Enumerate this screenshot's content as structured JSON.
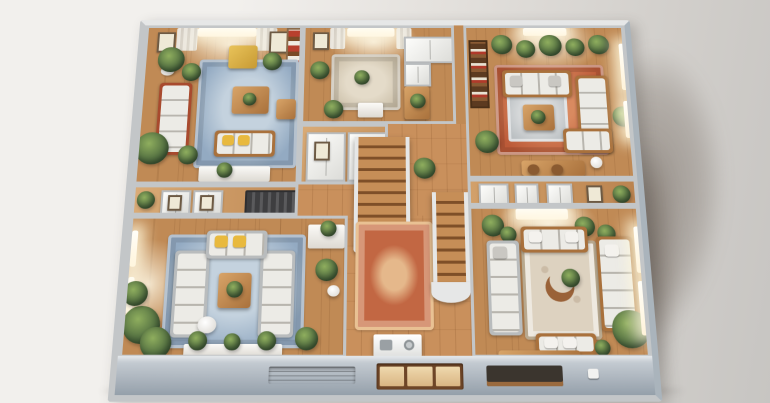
{
  "scene": {
    "description": "Photorealistic isometric 3D cutaway dollhouse model of an apartment floor plan with four furnished lounge rooms, a central wooden staircase hall, hardwood floors, area rugs and many potted plants, photographed on a neutral studio backdrop with a soft shadow cast to the right",
    "view": "top-down isometric cutaway, walls sliced horizontally",
    "lighting": "warm sunlight through windows, studio ambient"
  },
  "palette": {
    "bg_light": "#f2f0ed",
    "bg_mid": "#e4e1dd",
    "bg_dark": "#d3d0cc",
    "bg_darker": "#c7c5c2",
    "shadow_strong": "rgba(92,80,70,0.5)",
    "shadow_soft": "rgba(92,80,70,0.25)",
    "wall": "#c3c6c8",
    "wall_light": "#e6e7e7",
    "wall_edge": "#aab4bc",
    "wood": "#c08a55",
    "wood_light": "#dcab74",
    "wood_dark": "#a06a3a",
    "parquet": "#c9905c",
    "wood_furn": "#a9713c",
    "stair_light": "#c68e57",
    "stair_dark": "#7e4f28",
    "rug_blue": "#93aac2",
    "rug_blue_light": "#c4d2de",
    "rug_terra": "#bc5a38",
    "rug_terra_light": "#d98a60",
    "rug_persian": "#c26743",
    "rug_persian_trim": "#e9c193",
    "rug_cream": "#ddd2c0",
    "sofa_white": "#ecebe6",
    "sofa_frame_red": "#a84a2e",
    "accent_yellow": "#e8b93e",
    "plant_light": "#8fae5e",
    "plant_dark": "#44603a",
    "curtain": "#eceae4",
    "plinth_light": "#cdd3d9",
    "plinth": "#a9b2bb",
    "plinth_dark": "#8b97a2"
  },
  "rooms": {
    "nw": {
      "label": "Living room (north-west)",
      "features": [
        "sunlit window with sheer curtains",
        "framed botanical prints",
        "red-frame sofa with white cushions",
        "yellow armchair",
        "wood coffee table",
        "bench with yellow pillows",
        "blue patterned rug",
        "potted plants",
        "colorful shelf unit"
      ]
    },
    "n": {
      "label": "Study / utility room (north)",
      "features": [
        "window with curtains",
        "beige rug",
        "white appliance shelving",
        "wood counter",
        "potted plants"
      ]
    },
    "ne": {
      "label": "Lounge (north-east)",
      "features": [
        "dark bookshelf",
        "row of potted plants",
        "terracotta rug",
        "gray patterned rug",
        "wood-frame sofas with white cushions",
        "corner sectional",
        "coffee table with plant",
        "bar console with stools",
        "tall windows"
      ]
    },
    "closets": {
      "label": "Closet room",
      "features": [
        "white wardrobes"
      ]
    },
    "corridor_w": {
      "label": "West corridor",
      "features": [
        "framed pictures",
        "white closets",
        "dark slatted media unit",
        "plants"
      ]
    },
    "hall": {
      "label": "Central hall",
      "features": [
        "wooden staircase with white stringers",
        "second staircase",
        "persian terracotta rug",
        "white kitchen island with sink and hob",
        "parquet floor",
        "plants"
      ]
    },
    "band_e": {
      "label": "East hallway",
      "features": [
        "white doors",
        "closet panels"
      ]
    },
    "sw": {
      "label": "Family room (south-west)",
      "features": [
        "U-shaped white sectional",
        "yellow pillows",
        "blue rug",
        "wood coffee table with plant",
        "round side table",
        "white dresser",
        "lush plants",
        "white console with plant row",
        "windows with sunlight"
      ]
    },
    "se": {
      "label": "Lounge (south-east)",
      "features": [
        "skylight window",
        "white sofas around ornate cream rug",
        "driftwood crescent centerpiece",
        "gray chaise",
        "wood-frame sectional",
        "bench with white pillows",
        "large feathery plants",
        "tall windows on right wall"
      ]
    },
    "plinth": {
      "label": "Model base plinth",
      "features": [
        "recessed vent panel",
        "wood window inserts",
        "dark slot with sill",
        "switch block"
      ]
    }
  }
}
